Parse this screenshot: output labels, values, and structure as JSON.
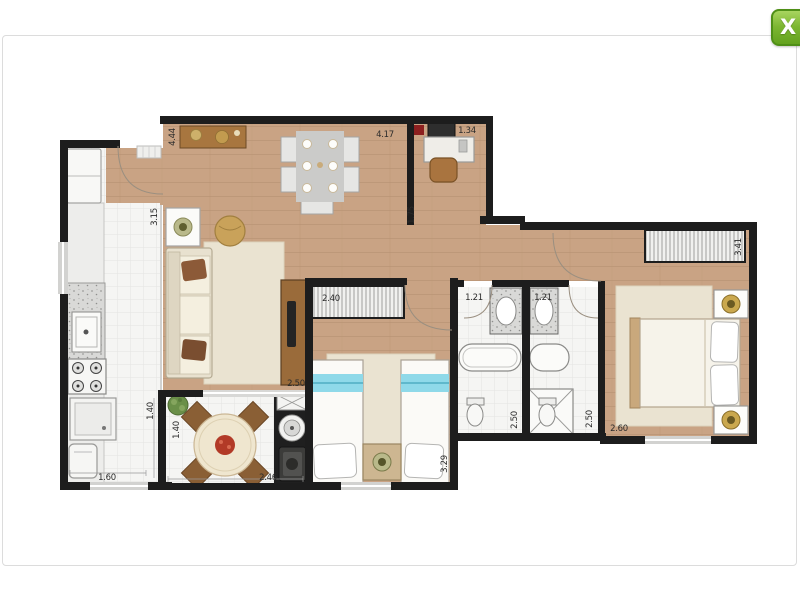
{
  "window": {
    "close_label": "X",
    "close_color": "#76b82a"
  },
  "colors": {
    "wall": "#1d1d1d",
    "wood_floor": "#c9a384",
    "tile_floor": "#f5f5f3",
    "accent_green": "#76b82a"
  },
  "floorplan": {
    "dims": {
      "entry_depth": "4.44",
      "living_width": "3.15",
      "kitchen_width": "1.40",
      "balcony_depth": "1.40",
      "kitchen_length": "1.60",
      "balcony_width": "2.46",
      "living_length": "2.50",
      "wardrobe2_width": "2.40",
      "bedroom2_depth": "3.29",
      "living_top_length": "4.17",
      "office_width": "1.34",
      "office_depth": "1.75",
      "bath1_width": "1.21",
      "bath2_width": "1.21",
      "bath1_depth": "2.50",
      "bath2_depth": "2.50",
      "bedroom1_width": "2.60",
      "bedroom1_depth": "3.41"
    }
  }
}
